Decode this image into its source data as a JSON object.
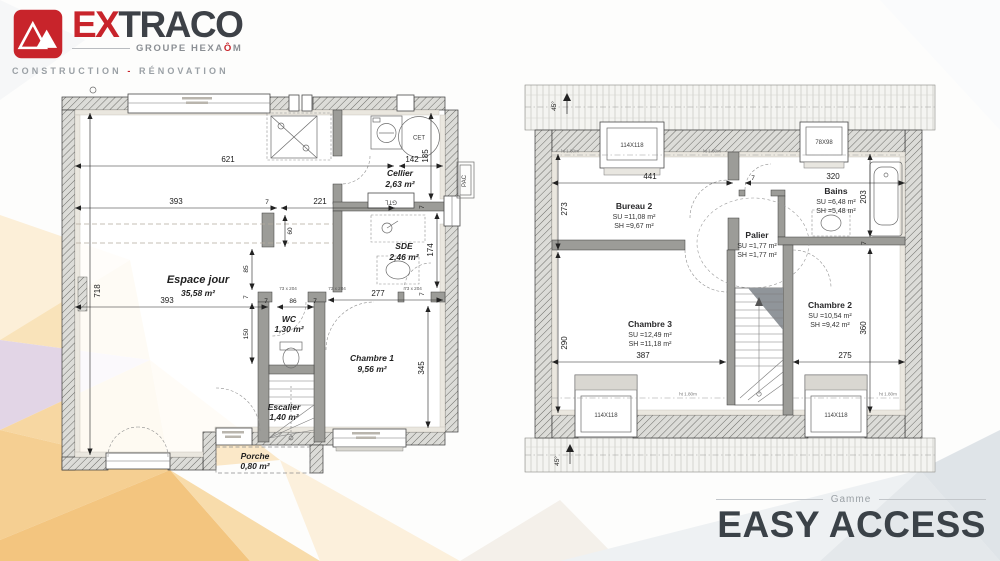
{
  "logo": {
    "ex": "EX",
    "traco": "TRACO",
    "group_a": "GROUPE HEXA",
    "group_o": "Ô",
    "group_m": "M",
    "tagline_a": "CONSTRUCTION",
    "tagline_dash": "-",
    "tagline_b": "RÉNOVATION"
  },
  "gamme": {
    "label": "Gamme",
    "name": "EASY ACCESS"
  },
  "ground_floor": {
    "rooms": [
      {
        "name": "Espace jour",
        "area": "35,58 m²"
      },
      {
        "name": "Cellier",
        "area": "2,63 m²"
      },
      {
        "name": "SDE",
        "area": "2,46 m²"
      },
      {
        "name": "WC",
        "area": "1,30 m²"
      },
      {
        "name": "Chambre 1",
        "area": "9,56 m²"
      },
      {
        "name": "Escalier",
        "area": "1,40 m²"
      },
      {
        "name": "Porche",
        "area": "0,80 m²"
      }
    ],
    "dims": {
      "d621": "621",
      "d142": "142",
      "d185": "185",
      "d393a": "393",
      "d7a": "7",
      "d221": "221",
      "d718": "718",
      "d60": "60",
      "d85": "85",
      "d7b": "7",
      "d150": "150",
      "d393b": "393",
      "d7c": "7",
      "d86": "86",
      "d7d": "7",
      "d277": "277",
      "d174": "174",
      "d7e": "7",
      "d345": "345",
      "d7f": "7"
    },
    "labels": {
      "gtl": "GTL",
      "cet": "CET",
      "pac": "PAC",
      "door": "73 x 204"
    }
  },
  "first_floor": {
    "rooms": [
      {
        "name": "Bureau 2",
        "su": "SU =11,08 m²",
        "sh": "SH =9,67 m²"
      },
      {
        "name": "Bains",
        "su": "SU =6,48 m²",
        "sh": "SH =5,48 m²"
      },
      {
        "name": "Palier",
        "su": "SU =1,77 m²",
        "sh": "SH =1,77 m²"
      },
      {
        "name": "Chambre 3",
        "su": "SU =12,49 m²",
        "sh": "SH =11,18 m²"
      },
      {
        "name": "Chambre 2",
        "su": "SU =10,54 m²",
        "sh": "SH =9,42 m²"
      }
    ],
    "windows": {
      "w1": "114X118",
      "w2": "78X98",
      "w3": "114X118",
      "w4": "114X118"
    },
    "dims": {
      "d441": "441",
      "d7a": "7",
      "d320": "320",
      "d273": "273",
      "d203": "203",
      "d7b": "7",
      "d290": "290",
      "d360": "360",
      "d387": "387",
      "d275": "275"
    },
    "roof_angle": "45°",
    "height_mark": "ht 1.80m"
  }
}
